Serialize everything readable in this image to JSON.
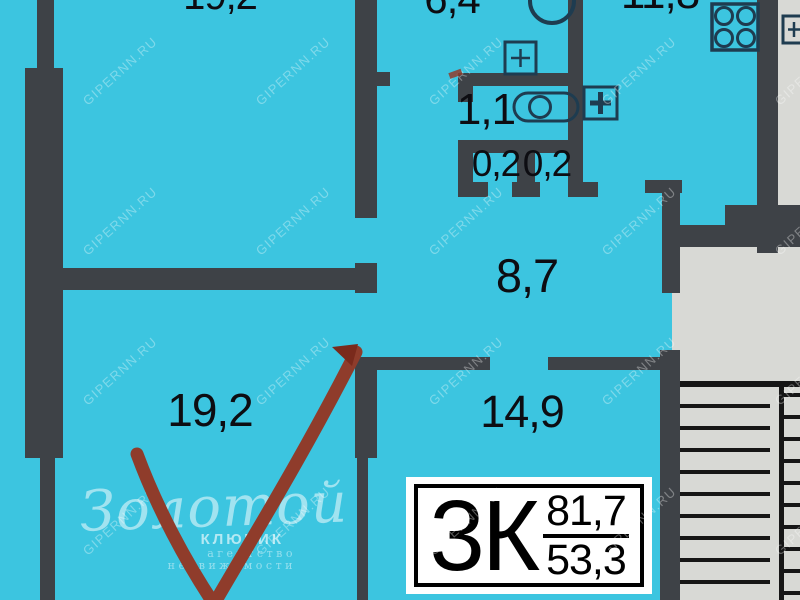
{
  "colors": {
    "floor": "#3CC5E0",
    "wall": "#3E4247",
    "stairwell": "#D8D9D5",
    "stairline": "#161616",
    "icon": "#1E3C50",
    "label": "#0D0D12",
    "mark": "#8F3C2B",
    "marktip": "#7A2A1C"
  },
  "watermark": {
    "text": "GIPERNN.RU"
  },
  "rooms": [
    {
      "name": "room-top-left",
      "area": "19,2"
    },
    {
      "name": "bathroom",
      "area": "6,4"
    },
    {
      "name": "kitchen",
      "area": "11,8"
    },
    {
      "name": "wc",
      "area": "1,1"
    },
    {
      "name": "closet-left",
      "area": "0,2"
    },
    {
      "name": "closet-right",
      "area": "0,2"
    },
    {
      "name": "hallway",
      "area": "8,7"
    },
    {
      "name": "room-bottom-left",
      "area": "19,2"
    },
    {
      "name": "room-bottom-middle",
      "area": "14,9"
    }
  ],
  "apartment": {
    "type": "3К",
    "total_area": "81,7",
    "living_area": "53,3"
  },
  "agency_logo": {
    "script": "Золотой",
    "word": "КЛЮЧИК",
    "sub1": "агентство",
    "sub2": "недвижимости"
  },
  "icons": [
    {
      "name": "wash-basin-icon"
    },
    {
      "name": "vent-plus-icon-bath"
    },
    {
      "name": "toilet-icon"
    },
    {
      "name": "vent-plus-icon-kitchen"
    },
    {
      "name": "stove-burners-icon"
    },
    {
      "name": "vent-plus-icon-corner"
    }
  ]
}
